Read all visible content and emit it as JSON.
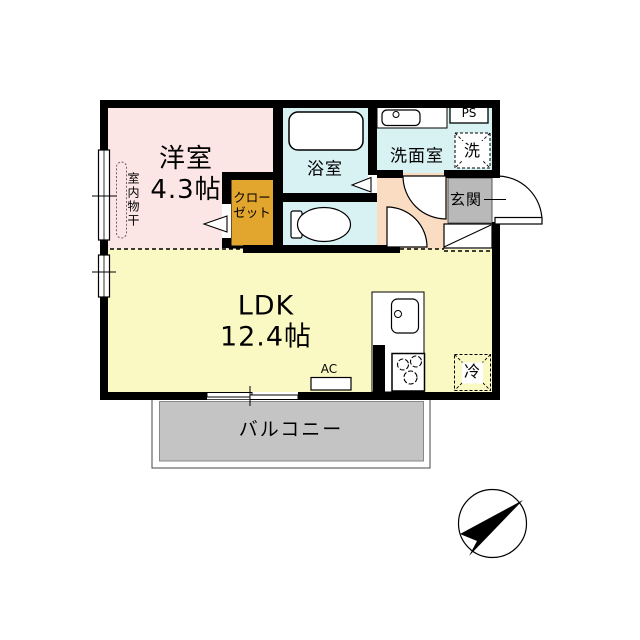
{
  "rooms": {
    "western": {
      "label": "洋室",
      "size": "4.3帖"
    },
    "ldk": {
      "label": "LDK",
      "size": "12.4帖"
    },
    "bath": {
      "label": "浴室"
    },
    "washroom": {
      "label": "洗面室"
    },
    "genkan": {
      "label": "玄関"
    },
    "closet": {
      "line1": "クロー",
      "line2": "ゼット"
    },
    "balcony": {
      "label": "バルコニー"
    }
  },
  "fixtures": {
    "laundry": "洗",
    "fridge": "冷",
    "ac": "AC",
    "ps": "PS",
    "indoor_drying": "室内物干"
  },
  "colors": {
    "western_room": "#fbe5e5",
    "wet_area": "#d8f2f4",
    "ldk": "#fbf9c3",
    "closet": "#e2a52e",
    "corridor": "#fadcc2",
    "genkan": "#b9b9b9",
    "balcony": "#c4c4c4",
    "wall": "#000000"
  }
}
